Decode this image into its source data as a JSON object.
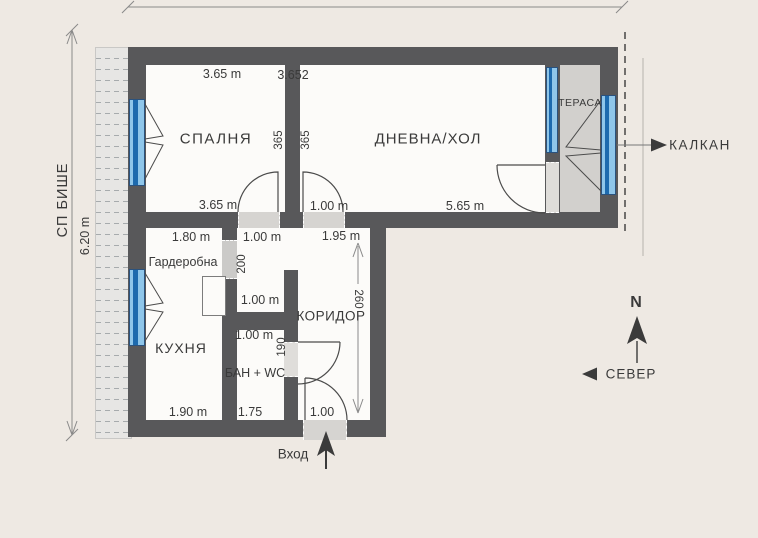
{
  "rooms": {
    "bedroom": "СПАЛНЯ",
    "living": "ДНЕВНА/ХОЛ",
    "terrace": "ТЕРАСА",
    "kitchen": "КУХНЯ",
    "wardrobe": "Гардеробна",
    "corridor": "КОРИДОР",
    "bathroom": "БАН + WC"
  },
  "annotations": {
    "kalkan": "КАЛКАН",
    "north_letter": "N",
    "north_word": "СЕВЕР",
    "entrance": "Вход",
    "side_strip": "СП БИШЕ",
    "side_strip_length": "6.20 m"
  },
  "dimensions": {
    "bedroom_top": "3.65 m",
    "divider_top": "3.652",
    "bedroom_side": "365",
    "living_side": "365",
    "bedroom_bottom": "3.65 m",
    "living_door": "1.00 m",
    "living_bottom": "5.65 m",
    "wardrobe_top": "1.80 m",
    "passage_top": "1.00 m",
    "corridor_top": "1.95 m",
    "passage_length": "200",
    "passage_bottom": "1.00 m",
    "corridor_length": "260",
    "bath_top": "1.00 m",
    "bath_side": "190",
    "kitchen_bottom": "1.90 m",
    "bath_bottom": "1.75",
    "entrance_width": "1.00"
  },
  "colors": {
    "wall": "#58585A",
    "floor": "#FCFBF9",
    "terrace_floor": "#D2D0CD",
    "window_light": "#8FC6EA",
    "window_dark": "#1D6AAE",
    "background": "#EEE9E3",
    "text": "#3A3A3A"
  }
}
